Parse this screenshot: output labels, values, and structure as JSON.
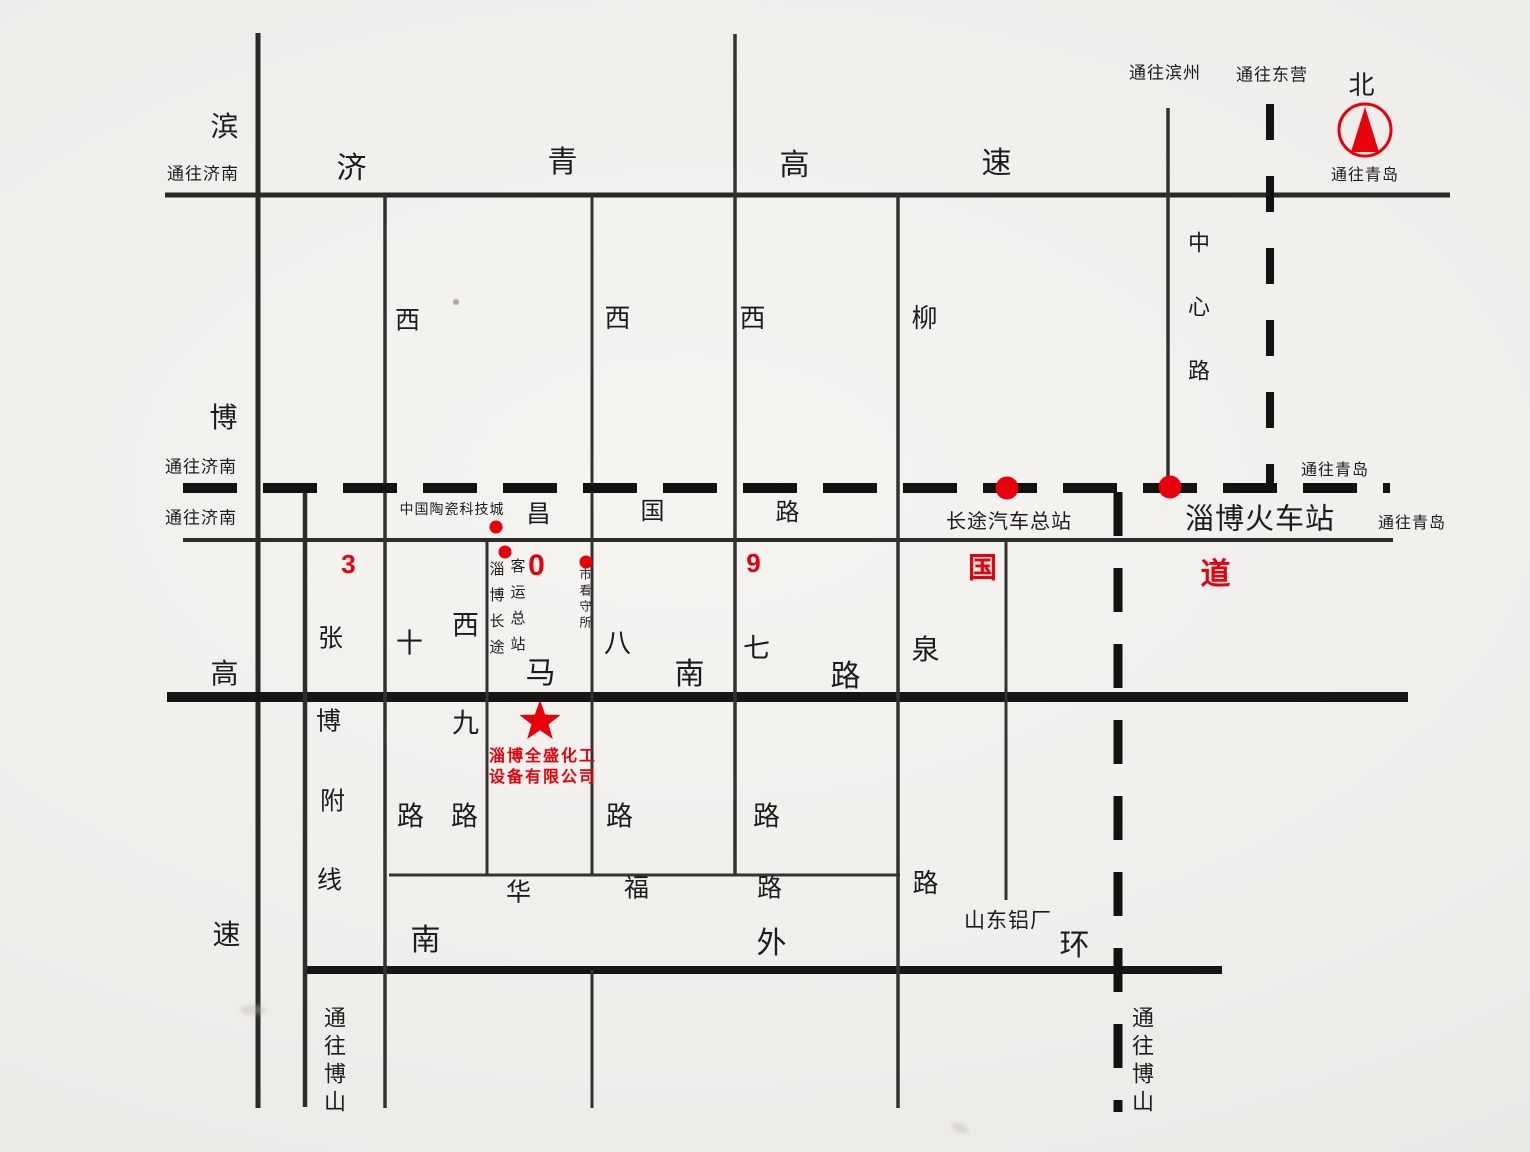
{
  "colors": {
    "ink": "#1c1c1c",
    "red": "#e8000d",
    "paper": "#f0eeeb"
  },
  "roads": {
    "binbo_expwy": {
      "chars": [
        "滨",
        "博",
        "高",
        "速"
      ]
    },
    "jiqing_expwy": {
      "chars": [
        "济",
        "青",
        "高",
        "速"
      ]
    },
    "changguo": {
      "chars": [
        "昌",
        "国",
        "路"
      ]
    },
    "route_309": {
      "chars": [
        "3",
        "0",
        "9",
        "国",
        "道"
      ]
    },
    "west10": {
      "chars": [
        "西",
        "十",
        "路"
      ]
    },
    "west9": {
      "chars": [
        "西",
        "九",
        "路"
      ]
    },
    "west8": {
      "chars": [
        "西",
        "八",
        "路"
      ]
    },
    "west7": {
      "chars": [
        "西",
        "七",
        "路"
      ]
    },
    "liuquan": {
      "chars": [
        "柳",
        "泉",
        "路"
      ]
    },
    "zhangbo_fuxian": {
      "chars": [
        "张",
        "博",
        "附",
        "线"
      ]
    },
    "manan": {
      "chars": [
        "马",
        "南",
        "路"
      ]
    },
    "huafu": {
      "chars": [
        "华",
        "福",
        "路"
      ]
    },
    "south_outer_ring": {
      "chars": [
        "南",
        "外",
        "环"
      ]
    },
    "zhongxin": {
      "label": "中心路"
    }
  },
  "directions": {
    "to_jinan_expwy": "通往济南",
    "to_jinan_railway": "通往济南",
    "to_jinan_changguo": "通往济南",
    "to_binzhou": "通往滨州",
    "to_dongying": "通往东营",
    "north": "北",
    "to_qingdao_expwy": "通往青岛",
    "to_qingdao_railway": "通往青岛",
    "to_qingdao_changguo": "通往青岛",
    "to_boshan_west": "通往博山",
    "to_boshan_east": "通往博山"
  },
  "places": {
    "ceramics_city": "中国陶瓷科技城",
    "bus_terminal_col1": "淄博长途",
    "bus_terminal_col2": "客运总站",
    "detention_center": "市看守所",
    "coach_terminal": "长途汽车总站",
    "train_station": "淄博火车站",
    "aluminum_plant": "山东铝厂",
    "company_name_line1": "淄博全盛化工",
    "company_name_line2": "设备有限公司"
  }
}
